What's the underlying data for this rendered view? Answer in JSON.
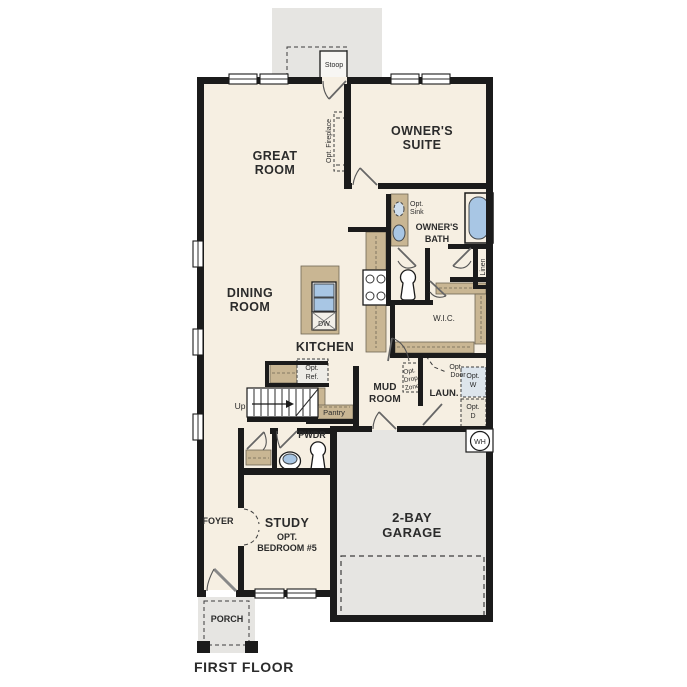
{
  "title": "FIRST FLOOR",
  "colors": {
    "wall": "#1b1b1b",
    "floor": "#f6efe2",
    "exterior_gray": "#e6e5e2",
    "cabinet_tan": "#c9b693",
    "fixture_blue": "#a8c6e4",
    "text": "#2b2b2b"
  },
  "labels": {
    "first_floor": "FIRST FLOOR",
    "stoop": "Stoop",
    "great_room": [
      "GREAT",
      "ROOM"
    ],
    "owners_suite": [
      "OWNER'S",
      "SUITE"
    ],
    "opt_fireplace": "Opt. Fireplace",
    "opt_sink": [
      "Opt.",
      "Sink"
    ],
    "owners_bath": [
      "OWNER'S",
      "BATH"
    ],
    "linen": "Linen",
    "wic": "W.I.C.",
    "dining_room": [
      "DINING",
      "ROOM"
    ],
    "kitchen": "KITCHEN",
    "dw": "DW",
    "up": "Up",
    "opt_ref": [
      "Opt.",
      "Ref."
    ],
    "pantry": "Pantry",
    "mud_room": [
      "MUD",
      "ROOM"
    ],
    "opt_drop_zone": [
      "Opt.",
      "Drop",
      "Zone"
    ],
    "laun": "LAUN.",
    "opt_door": [
      "Opt.",
      "Door"
    ],
    "opt_w": [
      "Opt.",
      "W"
    ],
    "opt_d": [
      "Opt.",
      "D"
    ],
    "wh": "WH",
    "garage": [
      "2-BAY",
      "GARAGE"
    ],
    "pwdr": "PWDR",
    "foyer": "FOYER",
    "study": [
      "STUDY",
      "OPT.",
      "BEDROOM #5"
    ],
    "porch": "PORCH"
  }
}
